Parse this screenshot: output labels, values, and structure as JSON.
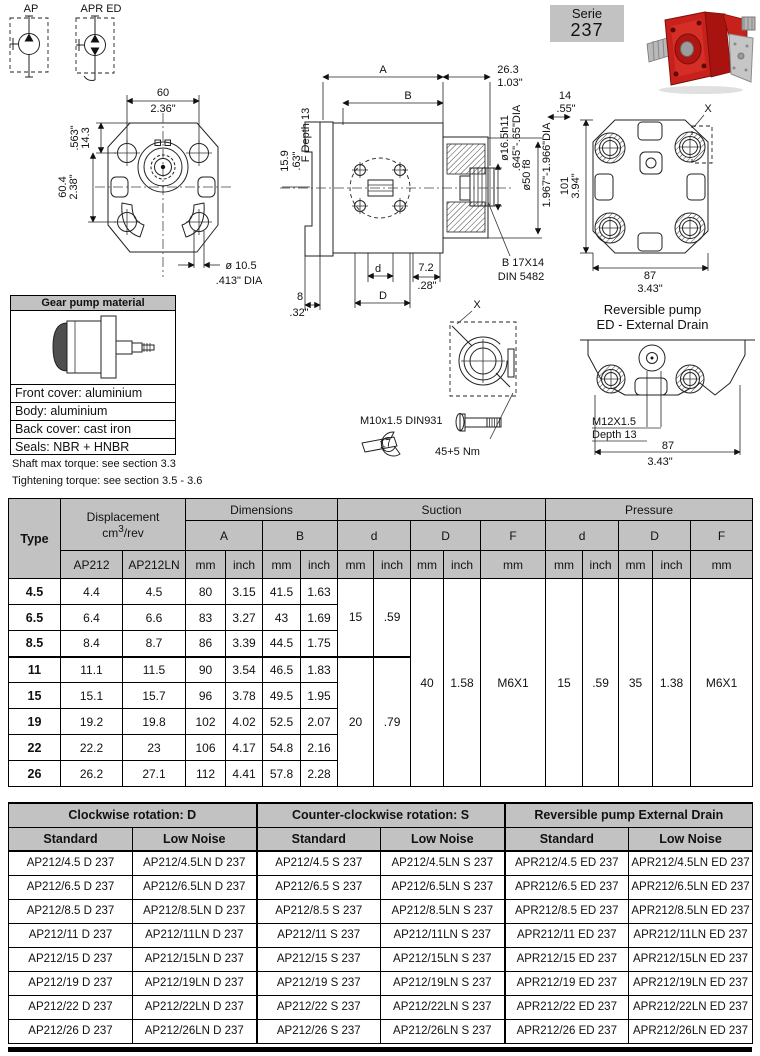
{
  "header": {
    "symbol_ap": "AP",
    "symbol_apred": "APR ED",
    "serie_label": "Serie",
    "serie_number": "237"
  },
  "front_view": {
    "w_mm": "60",
    "w_in": "2.36\"",
    "offset_mm": "14.3",
    "offset_in": ".563\"",
    "h_mm": "60.4",
    "h_in": "2.38\"",
    "hole_dia": "ø 10.5",
    "hole_dia_in": ".413\" DIA",
    "flange_mm": "15.9",
    "flange_in": ".63\""
  },
  "side_view": {
    "dim_a": "A",
    "dim_b": "B",
    "len_mm": "26.3",
    "len_in": "1.03\"",
    "spline_len_mm": "14",
    "spline_len_in": ".55\"",
    "shaft_dia": "ø16.5h11",
    "shaft_dia_in": ".645\"-.65\"DIA",
    "pilot_dia": "ø50 f8",
    "pilot_dia_in": "1.967\"-1.966\"DIA",
    "f_depth": "F Depth 13",
    "spline_type": "B 17X14",
    "spline_std": "DIN 5482",
    "dim_d": "d",
    "dim_D": "D",
    "port_mm": "7.2",
    "port_in": ".28\"",
    "edge_mm": "8",
    "edge_in": ".32\""
  },
  "back_view": {
    "h_mm": "101",
    "h_in": "3.94\"",
    "w_mm": "87",
    "w_in": "3.43\"",
    "detail_label": "X"
  },
  "x_detail": {
    "label": "X",
    "bolt": "M10x1.5 DIN931",
    "wrench_size": "17",
    "torque": "45+5 Nm"
  },
  "reversible": {
    "title1": "Reversible pump",
    "title2": "ED - External Drain",
    "thread": "M12X1.5",
    "depth": "Depth 13",
    "w_mm": "87",
    "w_in": "3.43\""
  },
  "material_box": {
    "title": "Gear pump material",
    "rows": [
      "Front cover: aluminium",
      "Body: aluminium",
      "Back cover: cast iron",
      "Seals: NBR + HNBR"
    ]
  },
  "notes": {
    "shaft": "Shaft max torque: see section 3.3",
    "tightening": "Tightening torque: see section 3.5 - 3.6"
  },
  "main_table": {
    "type_label": "Type",
    "displacement_label": "Displacement",
    "unit_base": "cm",
    "unit_sup": "3",
    "unit_rest": "/rev",
    "col_ap212": "AP212",
    "col_ap212ln": "AP212LN",
    "dimensions_label": "Dimensions",
    "suction_label": "Suction",
    "pressure_label": "Pressure",
    "sub_a": "A",
    "sub_b": "B",
    "sub_d": "d",
    "sub_dd": "D",
    "sub_f": "F",
    "unit_mm": "mm",
    "unit_inch": "inch",
    "rows": [
      [
        "4.5",
        "4.4",
        "4.5",
        "80",
        "3.15",
        "41.5",
        "1.63"
      ],
      [
        "6.5",
        "6.4",
        "6.6",
        "83",
        "3.27",
        "43",
        "1.69"
      ],
      [
        "8.5",
        "8.4",
        "8.7",
        "86",
        "3.39",
        "44.5",
        "1.75"
      ],
      [
        "11",
        "11.1",
        "11.5",
        "90",
        "3.54",
        "46.5",
        "1.83"
      ],
      [
        "15",
        "15.1",
        "15.7",
        "96",
        "3.78",
        "49.5",
        "1.95"
      ],
      [
        "19",
        "19.2",
        "19.8",
        "102",
        "4.02",
        "52.5",
        "2.07"
      ],
      [
        "22",
        "22.2",
        "23",
        "106",
        "4.17",
        "54.8",
        "2.16"
      ],
      [
        "26",
        "26.2",
        "27.1",
        "112",
        "4.41",
        "57.8",
        "2.28"
      ]
    ],
    "suction_d1_mm": "15",
    "suction_d1_in": ".59",
    "suction_d2_mm": "20",
    "suction_d2_in": ".79",
    "suction_D_mm": "40",
    "suction_D_in": "1.58",
    "suction_f": "M6X1",
    "pressure_d_mm": "15",
    "pressure_d_in": ".59",
    "pressure_D_mm": "35",
    "pressure_D_in": "1.38",
    "pressure_f": "M6X1"
  },
  "order_table": {
    "groups": [
      "Clockwise rotation: D",
      "Counter-clockwise rotation: S",
      "Reversible pump External Drain"
    ],
    "subheaders": [
      "Standard",
      "Low Noise",
      "Standard",
      "Low Noise",
      "Standard",
      "Low Noise"
    ],
    "rows": [
      [
        "AP212/4.5 D 237",
        "AP212/4.5LN D 237",
        "AP212/4.5 S 237",
        "AP212/4.5LN S 237",
        "APR212/4.5 ED 237",
        "APR212/4.5LN ED 237"
      ],
      [
        "AP212/6.5 D 237",
        "AP212/6.5LN D 237",
        "AP212/6.5 S 237",
        "AP212/6.5LN S 237",
        "APR212/6.5 ED 237",
        "APR212/6.5LN ED 237"
      ],
      [
        "AP212/8.5 D 237",
        "AP212/8.5LN D 237",
        "AP212/8.5 S 237",
        "AP212/8.5LN S 237",
        "APR212/8.5 ED 237",
        "APR212/8.5LN ED 237"
      ],
      [
        "AP212/11 D 237",
        "AP212/11LN D 237",
        "AP212/11 S 237",
        "AP212/11LN S 237",
        "APR212/11 ED 237",
        "APR212/11LN ED 237"
      ],
      [
        "AP212/15 D 237",
        "AP212/15LN D 237",
        "AP212/15 S 237",
        "AP212/15LN S 237",
        "APR212/15 ED 237",
        "APR212/15LN ED 237"
      ],
      [
        "AP212/19 D 237",
        "AP212/19LN D 237",
        "AP212/19 S 237",
        "AP212/19LN S 237",
        "APR212/19 ED 237",
        "APR212/19LN ED 237"
      ],
      [
        "AP212/22 D 237",
        "AP212/22LN D 237",
        "AP212/22 S 237",
        "AP212/22LN S 237",
        "APR212/22 ED 237",
        "APR212/22LN ED 237"
      ],
      [
        "AP212/26 D 237",
        "AP212/26LN D 237",
        "AP212/26 S 237",
        "AP212/26LN S 237",
        "APR212/26 ED 237",
        "APR212/26LN ED 237"
      ]
    ]
  },
  "colors": {
    "header_grey": "#c2c2c2",
    "pump_red": "#c41e16",
    "pump_grey": "#c6c6c6"
  }
}
